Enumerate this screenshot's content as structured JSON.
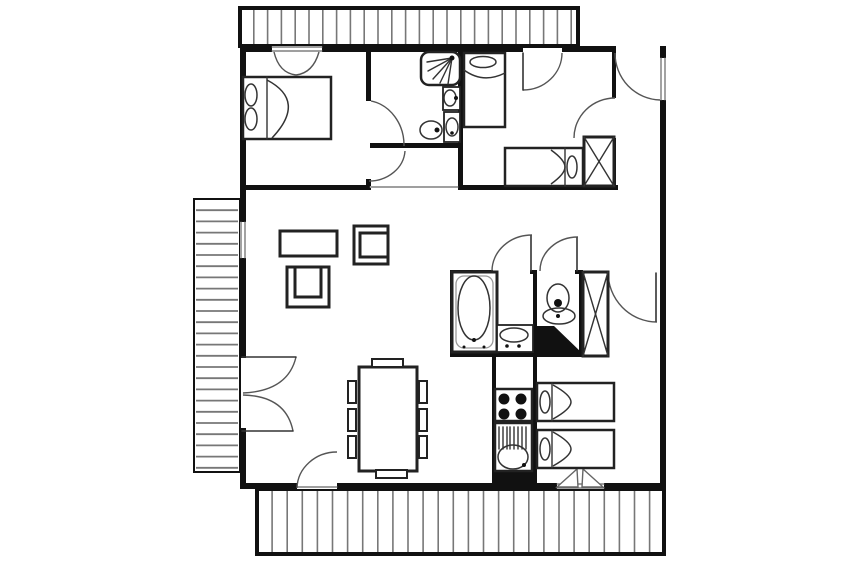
{
  "canvas": {
    "width": 862,
    "height": 575,
    "background": "#ffffff"
  },
  "colors": {
    "wall": "#111111",
    "furniture": "#222222",
    "fixture": "#333333",
    "thin": "#666666",
    "hatch": "#777777",
    "arc": "#555555",
    "fill_dark": "#111111"
  },
  "rooms": [
    {
      "name": "room-bedroom-1",
      "bbox": [
        246,
        52,
        120,
        132
      ]
    },
    {
      "name": "room-bathroom-1",
      "bbox": [
        371,
        52,
        87,
        90
      ]
    },
    {
      "name": "room-vestibule",
      "bbox": [
        371,
        148,
        87,
        37
      ]
    },
    {
      "name": "room-bedroom-2",
      "bbox": [
        463,
        52,
        148,
        132
      ]
    },
    {
      "name": "room-entry-corridor",
      "bbox": [
        616,
        53,
        44,
        136
      ]
    },
    {
      "name": "room-hallway",
      "bbox": [
        458,
        190,
        200,
        80
      ]
    },
    {
      "name": "room-living-room",
      "bbox": [
        246,
        190,
        210,
        292
      ]
    },
    {
      "name": "room-bathroom-2",
      "bbox": [
        453,
        274,
        80,
        78
      ]
    },
    {
      "name": "room-wc",
      "bbox": [
        537,
        274,
        42,
        51
      ]
    },
    {
      "name": "room-kitchen",
      "bbox": [
        496,
        357,
        37,
        114
      ]
    },
    {
      "name": "room-bedroom-3",
      "bbox": [
        537,
        357,
        123,
        126
      ]
    }
  ],
  "balconies": [
    {
      "name": "balcony-top",
      "x": 240,
      "y": 8,
      "w": 338,
      "h": 38,
      "hatch": "vertical",
      "spacing": 13.8,
      "border": 4
    },
    {
      "name": "balcony-bottom",
      "x": 257,
      "y": 489,
      "w": 407,
      "h": 65,
      "hatch": "vertical",
      "spacing": 15.1,
      "border": 4
    },
    {
      "name": "balcony-side-strip",
      "x": 194,
      "y": 199,
      "w": 46,
      "h": 273,
      "hatch": "horizontal",
      "spacing": 11.2,
      "border": 2
    }
  ],
  "walls": [
    [
      240,
      46,
      32,
      6
    ],
    [
      322,
      46,
      140,
      6
    ],
    [
      458,
      46,
      65,
      6
    ],
    [
      562,
      46,
      54,
      6
    ],
    [
      240,
      46,
      6,
      176
    ],
    [
      240,
      258,
      6,
      100
    ],
    [
      240,
      428,
      6,
      60
    ],
    [
      240,
      483,
      57,
      6
    ],
    [
      337,
      483,
      220,
      6
    ],
    [
      604,
      483,
      62,
      6
    ],
    [
      660,
      46,
      6,
      12
    ],
    [
      660,
      100,
      6,
      389
    ],
    [
      366,
      48,
      5,
      53
    ],
    [
      366,
      179,
      5,
      11
    ],
    [
      370,
      143,
      92,
      5
    ],
    [
      240,
      185,
      130,
      5
    ],
    [
      458,
      48,
      5,
      142
    ],
    [
      458,
      185,
      160,
      5
    ],
    [
      612,
      52,
      4,
      46
    ],
    [
      612,
      138,
      4,
      52
    ],
    [
      450,
      270,
      43,
      4
    ],
    [
      530,
      270,
      7,
      4
    ],
    [
      575,
      270,
      8,
      4
    ],
    [
      533,
      272,
      4,
      84
    ],
    [
      579,
      272,
      4,
      84
    ],
    [
      450,
      272,
      3,
      84
    ],
    [
      450,
      352,
      87,
      5
    ],
    [
      535,
      353,
      74,
      4
    ],
    [
      492,
      357,
      4,
      116
    ],
    [
      533,
      355,
      4,
      134
    ],
    [
      492,
      471,
      43,
      18
    ]
  ],
  "windows": [
    {
      "name": "window-bedroom-1-top",
      "rect": [
        272,
        46,
        50,
        6
      ],
      "lines": [
        [
          272,
          47,
          322,
          47
        ],
        [
          272,
          51,
          322,
          51
        ]
      ]
    },
    {
      "name": "window-living-left",
      "rect": [
        240,
        222,
        6,
        36
      ],
      "lines": [
        [
          241,
          222,
          241,
          258
        ],
        [
          245,
          222,
          245,
          258
        ]
      ]
    },
    {
      "name": "window-corridor-right",
      "rect": [
        660,
        58,
        6,
        42
      ],
      "lines": [
        [
          661,
          58,
          661,
          100
        ],
        [
          665,
          58,
          665,
          100
        ]
      ]
    },
    {
      "name": "window-bedroom-3-bottom",
      "rect": [
        557,
        483,
        47,
        6
      ],
      "lines": [
        [
          557,
          484,
          604,
          484
        ],
        [
          557,
          488,
          604,
          488
        ]
      ],
      "polys": [
        "557,487 577,469 578,487",
        "582,487 583,469 603,487"
      ]
    },
    {
      "name": "threshold-balcony-door-bottom",
      "rect": [
        297,
        483,
        40,
        6
      ],
      "lines": [
        [
          297,
          487,
          337,
          487
        ]
      ]
    },
    {
      "name": "threshold-vestibule",
      "rect": [
        370,
        186,
        88,
        2
      ],
      "lines": [
        [
          370,
          187,
          458,
          187
        ]
      ]
    }
  ],
  "doors": [
    {
      "name": "door-entry",
      "arc": "M615,53 A46,47 0 0 0 660,100",
      "leaf": null
    },
    {
      "name": "door-bedroom-2-balcony",
      "arc": "M562,53 A39,37 0 0 1 523,90",
      "leaf": [
        523,
        53,
        523,
        90
      ]
    },
    {
      "name": "casement-bedroom-1-left",
      "arc": "M274,52 Q279,73 296,75",
      "leaf": null
    },
    {
      "name": "casement-bedroom-1-right",
      "arc": "M319,52 Q313,73 296,75",
      "leaf": null
    },
    {
      "name": "door-bathroom-1",
      "arc": "M371,101 A40,45 0 0 1 404,146",
      "leaf": null
    },
    {
      "name": "door-bedroom-1",
      "arc": "M405,151 A36,32 0 0 1 369,181",
      "leaf": null
    },
    {
      "name": "door-bedroom-2",
      "arc": "M574,138 A41,40 0 0 1 615,98",
      "leaf": null
    },
    {
      "name": "french-door-left-upper",
      "arc": "M296,357 Q288,391 243,393",
      "leaf": [
        242,
        357,
        296,
        357
      ]
    },
    {
      "name": "french-door-left-lower",
      "arc": "M293,431 Q286,396 243,395",
      "leaf": [
        242,
        431,
        293,
        431
      ]
    },
    {
      "name": "door-living-balcony-bottom",
      "arc": "M297,488 A40,37 0 0 1 337,452",
      "leaf": null
    },
    {
      "name": "door-bathroom-2",
      "arc": "M492,271 A40,36 0 0 1 532,235",
      "leaf": [
        531,
        236,
        531,
        271
      ]
    },
    {
      "name": "door-wc",
      "arc": "M540,271 A38,34 0 0 1 578,237",
      "leaf": [
        577,
        238,
        577,
        271
      ]
    },
    {
      "name": "door-bedroom-3",
      "arc": "M608,272 A49,50 0 0 0 657,322",
      "leaf": [
        656,
        273,
        656,
        321
      ]
    }
  ],
  "furniture": [
    {
      "name": "double-bed",
      "rects": [
        [
          243,
          77,
          88,
          62,
          2.5
        ]
      ],
      "ovals": [
        [
          251,
          95,
          6,
          11
        ],
        [
          251,
          119,
          6,
          11
        ]
      ],
      "lines": [
        [
          267,
          77,
          267,
          139
        ]
      ],
      "paths": [
        {
          "d": "M267,80 Q307,101 272,138",
          "sw": 1.5
        }
      ]
    },
    {
      "name": "single-bed-vertical",
      "rects": [
        [
          464,
          53,
          41,
          74,
          2.5
        ]
      ],
      "ovals": [
        [
          483,
          62,
          13,
          5.5
        ]
      ],
      "paths": [
        {
          "d": "M464,70 Q483,84 505,73",
          "sw": 1.5
        }
      ]
    },
    {
      "name": "single-bed-bedroom-2",
      "rects": [
        [
          505,
          148,
          78,
          38,
          2.5
        ]
      ],
      "ovals": [
        [
          572,
          167,
          5,
          11
        ]
      ],
      "lines": [
        [
          565,
          148,
          565,
          186
        ]
      ],
      "paths": [
        {
          "d": "M551,150 Q565,160 565,167 Q565,174 551,184",
          "sw": 1.5
        }
      ]
    },
    {
      "name": "wardrobe-bedroom-2",
      "rects": [
        [
          584,
          137,
          30,
          49,
          3
        ]
      ],
      "lines": [
        [
          584,
          137,
          614,
          186
        ],
        [
          614,
          137,
          584,
          186
        ]
      ]
    },
    {
      "name": "wardrobe-hallway",
      "rects": [
        [
          583,
          272,
          25,
          84,
          3
        ]
      ],
      "lines": [
        [
          583,
          272,
          608,
          356
        ],
        [
          608,
          272,
          583,
          356
        ]
      ]
    },
    {
      "name": "shower",
      "rects": [
        [
          421,
          52,
          39,
          33,
          2.5,
          8
        ]
      ],
      "dots": [
        [
          452,
          58,
          2.5
        ]
      ],
      "lines": [
        [
          452,
          58,
          427,
          62
        ],
        [
          452,
          58,
          428,
          71
        ],
        [
          452,
          58,
          433,
          79
        ],
        [
          452,
          58,
          440,
          83
        ],
        [
          452,
          58,
          448,
          84
        ]
      ]
    },
    {
      "name": "sink-bathroom-1",
      "rects": [
        [
          443,
          87,
          17,
          23,
          1.8
        ]
      ],
      "ovals": [
        [
          450,
          98,
          6,
          8
        ]
      ],
      "dots": [
        [
          456,
          98,
          2
        ]
      ]
    },
    {
      "name": "toilet-bathroom-1",
      "rects": [
        [
          444,
          112,
          16,
          30,
          1.8
        ]
      ],
      "ovals": [
        [
          431,
          130,
          11,
          9
        ],
        [
          452,
          127,
          6,
          9
        ]
      ],
      "dots": [
        [
          437,
          130,
          2.5
        ],
        [
          452,
          133,
          1.8
        ]
      ]
    },
    {
      "name": "bathtub",
      "rects": [
        [
          452,
          272,
          45,
          80,
          3
        ],
        [
          456,
          276,
          37,
          72,
          1.3,
          8,
          "#999999"
        ]
      ],
      "ovals": [
        [
          474,
          308,
          16,
          32
        ]
      ],
      "dots": [
        [
          474,
          340,
          2
        ],
        [
          464,
          347,
          1.5
        ],
        [
          484,
          347,
          1.5
        ]
      ]
    },
    {
      "name": "sink-bathroom-2",
      "rects": [
        [
          497,
          325,
          36,
          27,
          1.8
        ]
      ],
      "ovals": [
        [
          514,
          335,
          14,
          7
        ]
      ],
      "dots": [
        [
          507,
          346,
          1.8
        ],
        [
          519,
          346,
          1.8
        ]
      ]
    },
    {
      "name": "toilet-wc",
      "ovals": [
        [
          558,
          298,
          11,
          14
        ],
        [
          559,
          316,
          16,
          8
        ]
      ],
      "dots": [
        [
          558,
          303,
          4
        ],
        [
          558,
          316,
          2
        ]
      ]
    },
    {
      "name": "flue-duct",
      "polys": [
        {
          "points": "537,326 554,326 582,353 537,353",
          "fill": "#111111"
        }
      ]
    },
    {
      "name": "stove",
      "rects": [
        [
          495,
          389,
          37,
          32,
          2.5
        ]
      ],
      "dots": [
        [
          504,
          399,
          5.5
        ],
        [
          521,
          399,
          5.5
        ],
        [
          504,
          414,
          5.5
        ],
        [
          521,
          414,
          5.5
        ]
      ]
    },
    {
      "name": "kitchen-sink",
      "rects": [
        [
          495,
          423,
          37,
          48,
          2.5
        ]
      ],
      "lines": [
        [
          499,
          427,
          499,
          449
        ],
        [
          503,
          427,
          503,
          449
        ],
        [
          507,
          427,
          507,
          449
        ],
        [
          510,
          427,
          510,
          449
        ],
        [
          514,
          427,
          514,
          449
        ],
        [
          518,
          427,
          518,
          449
        ],
        [
          522,
          427,
          522,
          449
        ],
        [
          526,
          427,
          526,
          449
        ]
      ],
      "ovals": [
        [
          513,
          457,
          15,
          12
        ]
      ],
      "dots": [
        [
          524,
          465,
          2
        ]
      ]
    },
    {
      "name": "single-bed-3a",
      "rects": [
        [
          537,
          383,
          77,
          38,
          2.5
        ]
      ],
      "ovals": [
        [
          545,
          402,
          5,
          11
        ]
      ],
      "lines": [
        [
          552,
          383,
          552,
          421
        ]
      ],
      "paths": [
        {
          "d": "M553,385 Q571,395 571,402 Q571,409 553,419",
          "sw": 1.5
        }
      ]
    },
    {
      "name": "single-bed-3b",
      "rects": [
        [
          537,
          430,
          77,
          38,
          2.5
        ]
      ],
      "ovals": [
        [
          545,
          449,
          5,
          11
        ]
      ],
      "lines": [
        [
          552,
          430,
          552,
          468
        ]
      ],
      "paths": [
        {
          "d": "M553,432 Q571,442 571,449 Q571,456 553,466",
          "sw": 1.5
        }
      ]
    },
    {
      "name": "sofa-table",
      "rects": [
        [
          280,
          231,
          57,
          25,
          3
        ]
      ]
    },
    {
      "name": "armchair-east",
      "rects": [
        [
          354,
          226,
          34,
          38,
          3
        ],
        [
          360,
          233,
          28,
          24,
          3
        ]
      ]
    },
    {
      "name": "armchair-south",
      "rects": [
        [
          287,
          267,
          42,
          40,
          3
        ],
        [
          295,
          267,
          26,
          30,
          3
        ]
      ]
    },
    {
      "name": "dining-set",
      "rects": [
        [
          359,
          367,
          58,
          104,
          3
        ],
        [
          348,
          381,
          8,
          22,
          2
        ],
        [
          348,
          409,
          8,
          22,
          2
        ],
        [
          348,
          436,
          8,
          22,
          2
        ],
        [
          419,
          381,
          8,
          22,
          2
        ],
        [
          419,
          409,
          8,
          22,
          2
        ],
        [
          419,
          436,
          8,
          22,
          2
        ],
        [
          372,
          359,
          31,
          8,
          2
        ],
        [
          376,
          470,
          31,
          8,
          2
        ]
      ]
    }
  ]
}
